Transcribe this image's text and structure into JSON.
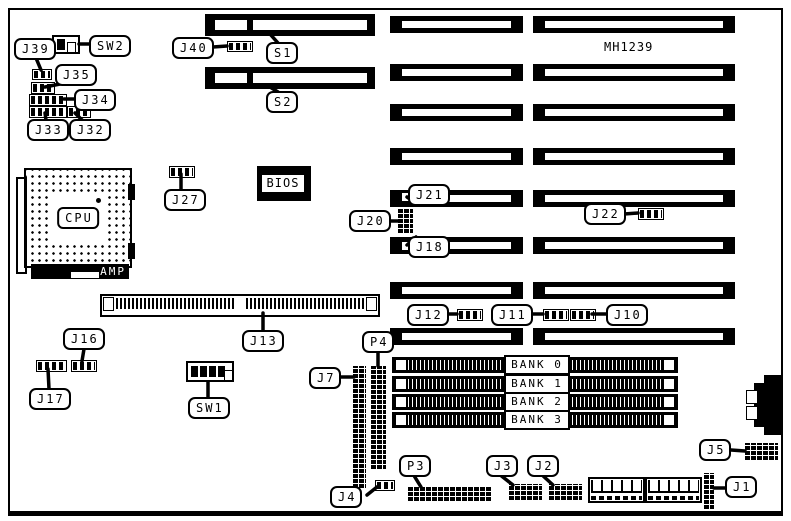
{
  "board": {
    "part_number": "MH1239"
  },
  "cpu": {
    "label": "CPU",
    "socket_brand": "AMP"
  },
  "bios": {
    "label": "BIOS"
  },
  "memory": {
    "banks": [
      {
        "label": "BANK 0"
      },
      {
        "label": "BANK 1"
      },
      {
        "label": "BANK 2"
      },
      {
        "label": "BANK 3"
      }
    ]
  },
  "callouts": {
    "j39": "J39",
    "sw2": "SW2",
    "j35": "J35",
    "j34": "J34",
    "j33": "J33",
    "j32": "J32",
    "j40": "J40",
    "s1": "S1",
    "s2": "S2",
    "j27": "J27",
    "j21": "J21",
    "j20": "J20",
    "j18": "J18",
    "j22": "J22",
    "j13": "J13",
    "j16": "J16",
    "j17": "J17",
    "sw1": "SW1",
    "j12": "J12",
    "j11": "J11",
    "j10": "J10",
    "p4": "P4",
    "j7": "J7",
    "j4": "J4",
    "p3": "P3",
    "j3": "J3",
    "j2": "J2",
    "j5": "J5",
    "j1": "J1"
  },
  "colors": {
    "ink": "#000000",
    "paper": "#ffffff"
  }
}
